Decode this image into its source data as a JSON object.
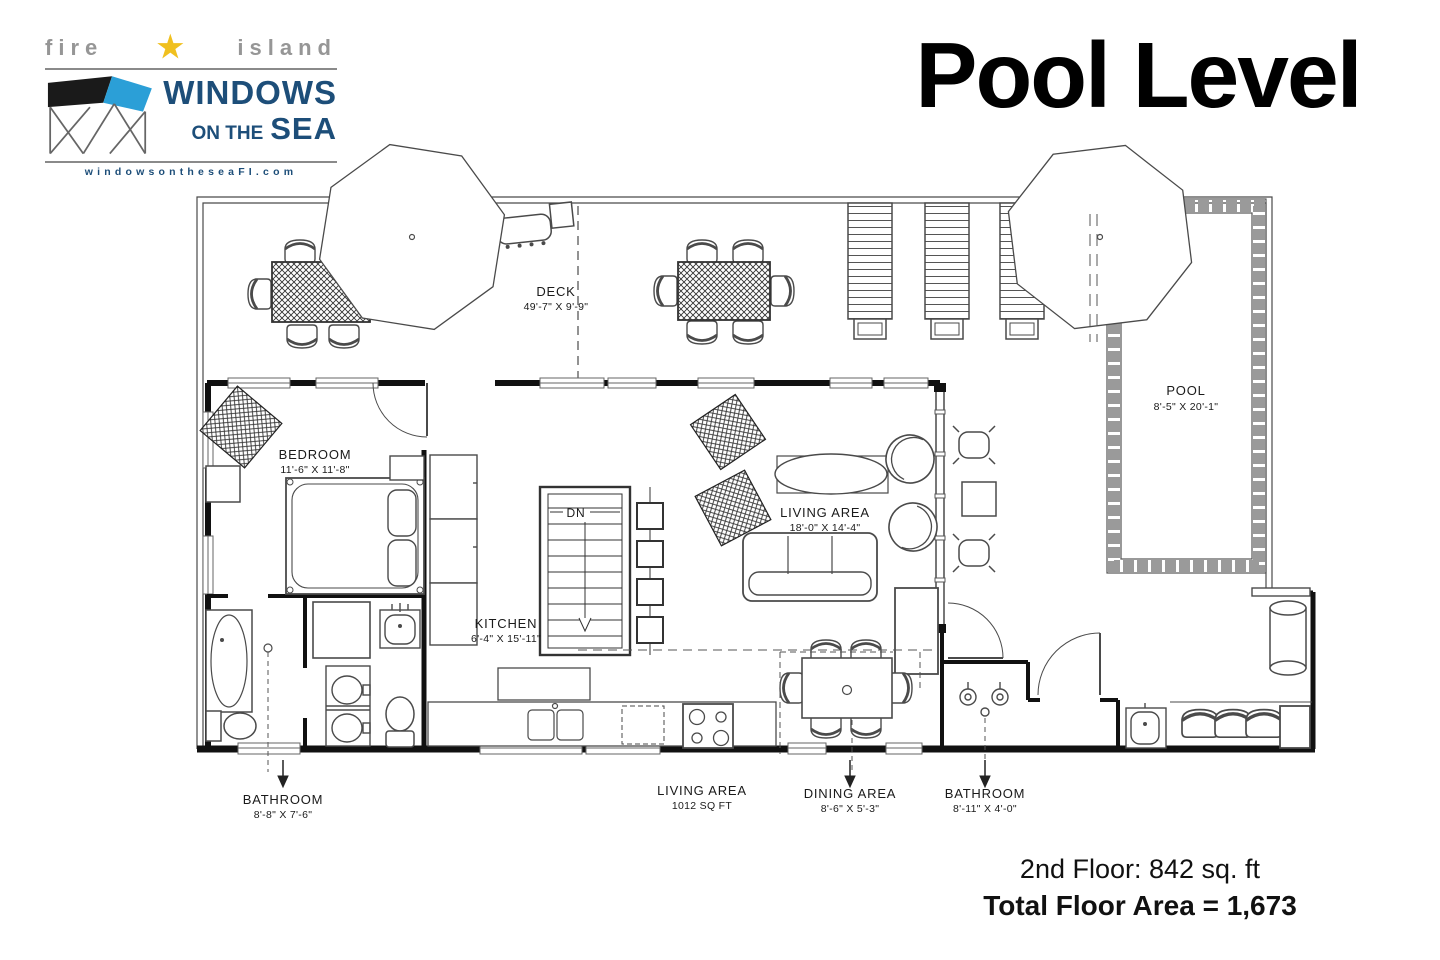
{
  "title": "Pool Level",
  "logo": {
    "tagline_left": "fire",
    "tagline_right": "island",
    "star": "★",
    "name_line1": "WINDOWS",
    "name_line2_prefix": "ON THE",
    "name_line2_word": "SEA",
    "website": "windowsontheseaFI.com"
  },
  "plan": {
    "deck": {
      "name": "DECK",
      "dims": "49'-7\" X 9'-9\""
    },
    "pool": {
      "name": "POOL",
      "dims": "8'-5\" X 20'-1\""
    },
    "bedroom": {
      "name": "BEDROOM",
      "dims": "11'-6\" X 11'-8\""
    },
    "kitchen": {
      "name": "KITCHEN",
      "dims": "6'-4\" X 15'-11\""
    },
    "living": {
      "name": "LIVING AREA",
      "dims": "18'-0\" X 14'-4\""
    },
    "stairs_label": "DN",
    "callouts": [
      {
        "name": "BATHROOM",
        "dims": "8'-8\" X 7'-6\""
      },
      {
        "name": "LIVING AREA",
        "dims": "1012 SQ FT"
      },
      {
        "name": "DINING AREA",
        "dims": "8'-6\" X 5'-3\""
      },
      {
        "name": "BATHROOM",
        "dims": "8'-11\" X 4'-0\""
      }
    ]
  },
  "footer": {
    "line1": "2nd Floor: 842 sq. ft",
    "line2": "Total Floor Area = 1,673"
  },
  "colors": {
    "logo_navy": "#1d4e79",
    "logo_gray": "#969696",
    "star_gold": "#f0c01f",
    "house_blue": "#2b9fd7",
    "ink": "#000000",
    "plan_line": "#4a4a4a"
  }
}
